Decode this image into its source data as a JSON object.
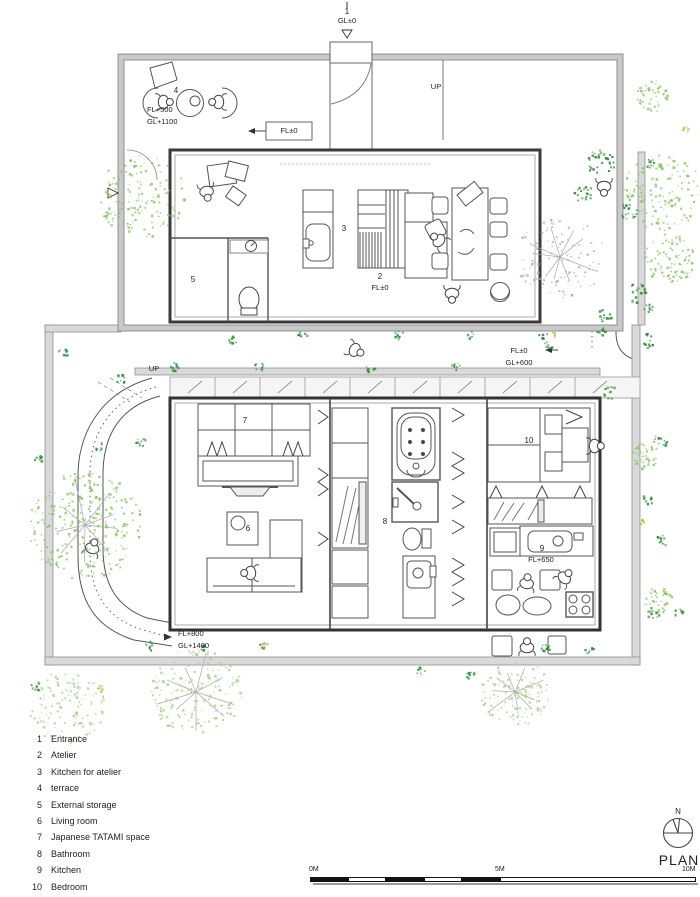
{
  "drawing": {
    "colors": {
      "foliage_light": "#86c75f",
      "foliage_pale": "#a9d58d",
      "foliage_gray": "#9fb89a",
      "foliage_dark": "#2e8b3a",
      "accent_yellow": "#b9b53a",
      "branch_gray": "#a8a8a8",
      "wall_gray": "#d9d9d9",
      "line_dark": "#3a3a3a"
    }
  },
  "plan_labels": {
    "entrance_num": "1",
    "entrance_gl": "GL±0",
    "terrace_num": "4",
    "terrace_fl": "FL+500",
    "terrace_gl": "GL+1100",
    "landing_fl": "FL±0",
    "up_ramp_top": "UP",
    "up_steps_mid": "UP",
    "atelier_kitchen_num": "3",
    "atelier_num": "2",
    "atelier_fl": "FL±0",
    "storage_num": "5",
    "court_fl": "FL±0",
    "court_gl": "GL+600",
    "tatami_num": "7",
    "living_num": "6",
    "bath_num": "8",
    "kitchen_num": "9",
    "kitchen_fl": "FL+650",
    "bedroom_num": "10",
    "lower_terrace_fl": "FL+800",
    "lower_terrace_gl": "GL+1400"
  },
  "legend": {
    "items": [
      {
        "num": "1",
        "label": "Entrance"
      },
      {
        "num": "2",
        "label": "Atelier"
      },
      {
        "num": "3",
        "label": "Kitchen for atelier"
      },
      {
        "num": "4",
        "label": "terrace"
      },
      {
        "num": "5",
        "label": "External storage"
      },
      {
        "num": "6",
        "label": "Living room"
      },
      {
        "num": "7",
        "label": "Japanese TATAMI space"
      },
      {
        "num": "8",
        "label": "Bathroom"
      },
      {
        "num": "9",
        "label": "Kitchen"
      },
      {
        "num": "10",
        "label": "Bedroom"
      }
    ]
  },
  "compass": {
    "north": "N",
    "caption": "PLAN"
  },
  "scale_bar": {
    "start": "0M",
    "mid": "5M",
    "end": "10M"
  }
}
